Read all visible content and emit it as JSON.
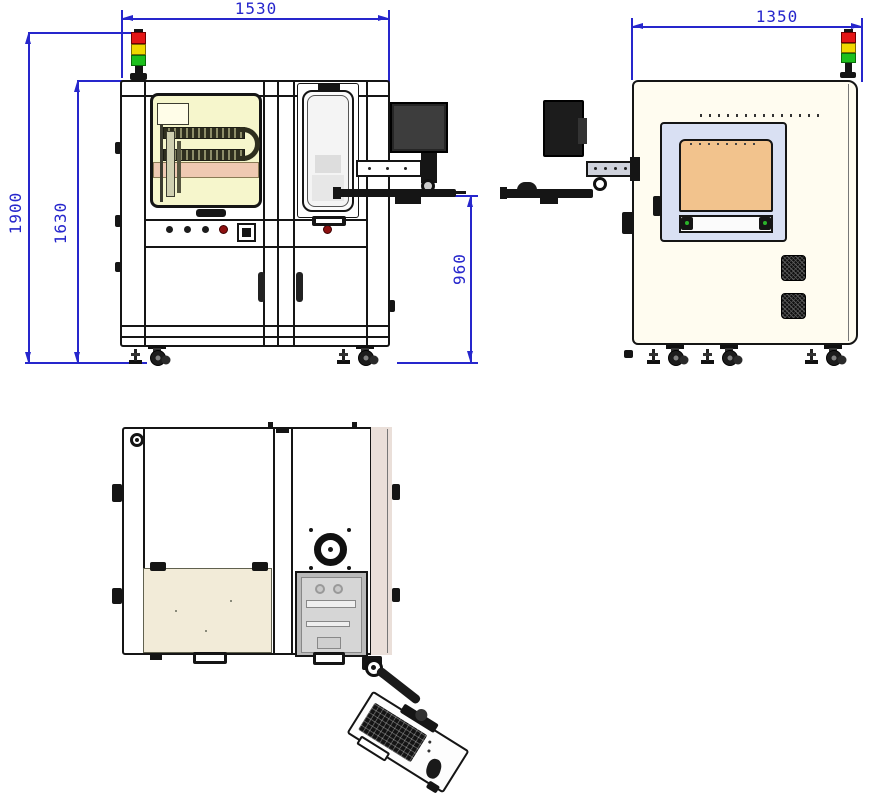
{
  "dimensions": {
    "front_width": "1530",
    "side_depth": "1350",
    "overall_height": "1900",
    "body_height": "1630",
    "keyboard_height": "960"
  },
  "colors": {
    "dimension_blue": "#2626cc",
    "outline_black": "#151515",
    "signal_red": "#e31616",
    "signal_yellow": "#f0d800",
    "signal_green": "#1dbf1d",
    "window_tint_yellow": "#f6f6cc",
    "salmon_band": "#efc9b2",
    "side_body_ivory": "#fffcf0",
    "side_window_frame_blue": "#d9e0f3",
    "side_window_panel_orange": "#f2c38d",
    "top_panel_beige": "#f2ebd8",
    "hatch_gray": "#c9c9c9",
    "right_bar_tan": "#eadfd9"
  },
  "icons": {
    "signal_tower": "red-yellow-green stack light",
    "fan": "circular exhaust fan",
    "caster": "leveling foot with caster wheel"
  }
}
